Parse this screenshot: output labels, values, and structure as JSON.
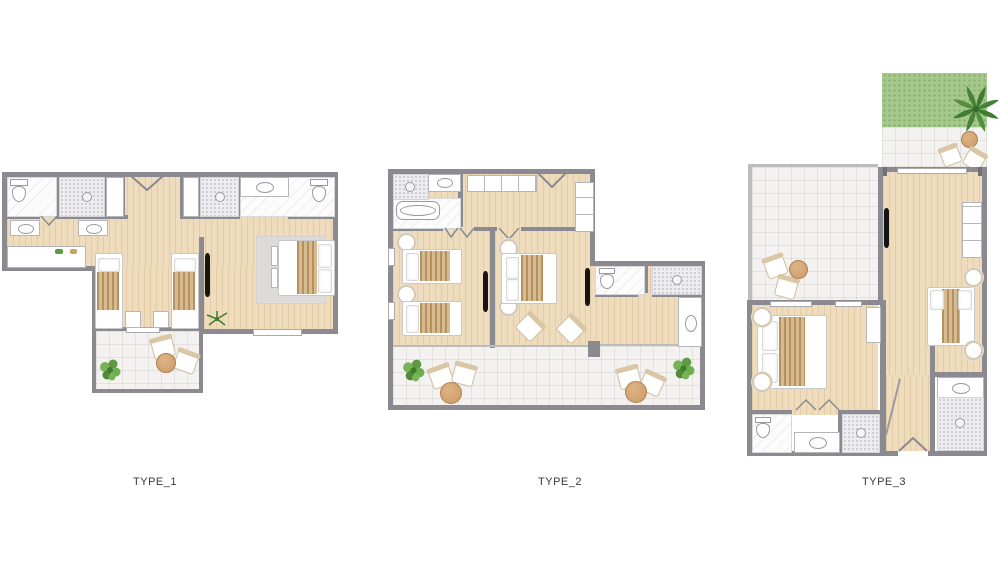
{
  "page": {
    "background": "#ffffff"
  },
  "palette": {
    "page_bg": "#ffffff",
    "wall": "#8a8a90",
    "wall_dark": "#707076",
    "railing": "#bcbcbf",
    "wood_floor": "#eedcbc",
    "tile_floor": "#f3f2f0",
    "bath_floor": "#fcfcfc",
    "mosaic_tile": "#ededef",
    "grass": "#a5c88b",
    "plant_green": "#67a84c",
    "palm_green": "#47823a",
    "blanket_tan": "#c7a77d",
    "table_wood": "#cd9a66",
    "tv_black": "#141414",
    "label_text": "#3a3a3a"
  },
  "plans": [
    {
      "id": "type-1",
      "label": "TYPE_1"
    },
    {
      "id": "type-2",
      "label": "TYPE_2"
    },
    {
      "id": "type-3",
      "label": "TYPE_3"
    }
  ]
}
